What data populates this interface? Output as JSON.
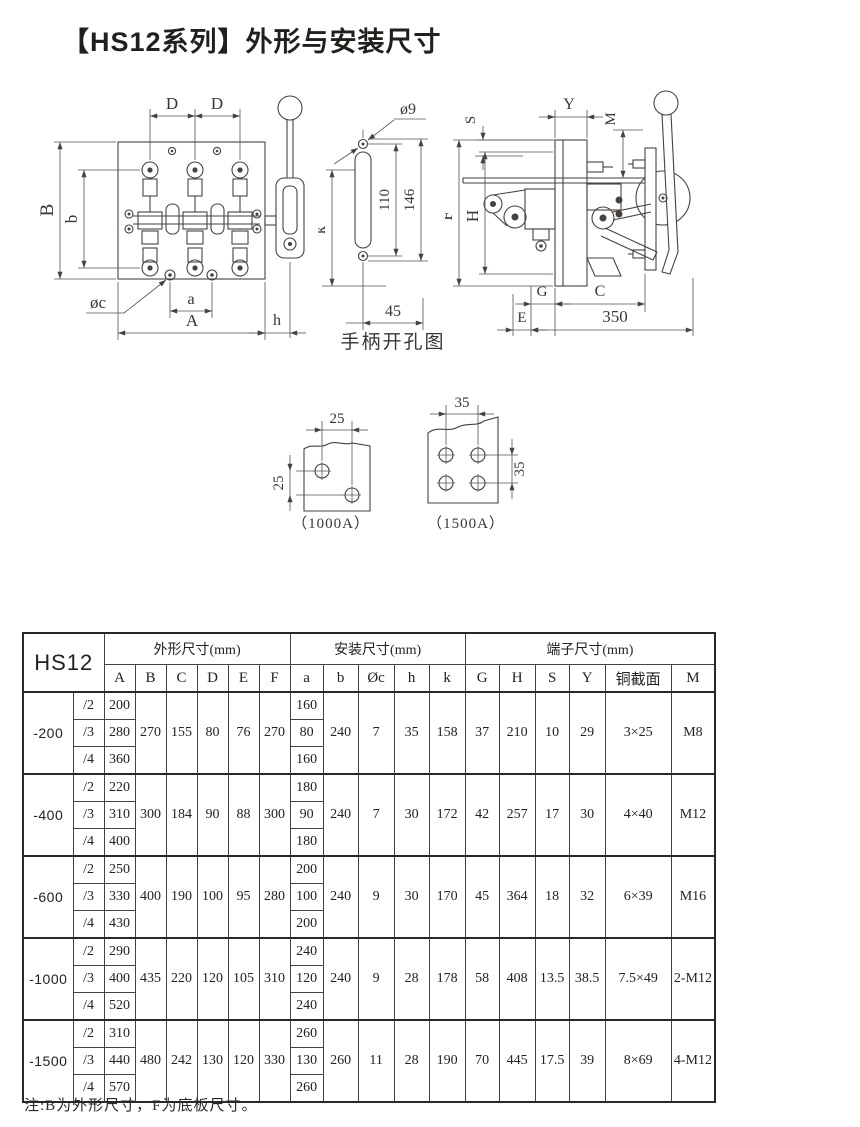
{
  "page": {
    "title": "【HS12系列】外形与安装尺寸",
    "note": "注:B为外形尺寸，F为底板尺寸。"
  },
  "figures": {
    "front_view": {
      "dims": {
        "D1": "D",
        "D2": "D",
        "B": "B",
        "b": "b",
        "phiC": "øc",
        "a": "a",
        "A": "A",
        "h": "h"
      }
    },
    "handle_cutout": {
      "caption": "手柄开孔图",
      "dims": {
        "phi9": "ø9",
        "v110": "110",
        "v146": "146",
        "k": "k",
        "h45": "45"
      }
    },
    "side_view": {
      "dims": {
        "S": "S",
        "Y": "Y",
        "M": "M",
        "F": "F",
        "H": "H",
        "G": "G",
        "C": "C",
        "E": "E",
        "w350": "350"
      }
    },
    "hole_1000A": {
      "caption": "（1000A）",
      "dims": {
        "h25": "25",
        "v25": "25"
      }
    },
    "hole_1500A": {
      "caption": "（1500A）",
      "dims": {
        "h35": "35",
        "v35": "35"
      }
    }
  },
  "table": {
    "model_header": "HS12",
    "groups": [
      {
        "label": "外形尺寸(mm)",
        "cols": [
          "A",
          "B",
          "C",
          "D",
          "E",
          "F"
        ]
      },
      {
        "label": "安装尺寸(mm)",
        "cols": [
          "a",
          "b",
          "Øc",
          "h",
          "k"
        ]
      },
      {
        "label": "端子尺寸(mm)",
        "cols": [
          "G",
          "H",
          "S",
          "Y",
          "铜截面",
          "M"
        ]
      }
    ],
    "rows": [
      {
        "model": "-200",
        "variants": [
          [
            "/2",
            "200",
            "160"
          ],
          [
            "/3",
            "280",
            "80"
          ],
          [
            "/4",
            "360",
            "160"
          ]
        ],
        "merged": [
          "270",
          "155",
          "80",
          "76",
          "270",
          "240",
          "7",
          "35",
          "158",
          "37",
          "210",
          "10",
          "29",
          "3×25",
          "M8"
        ]
      },
      {
        "model": "-400",
        "variants": [
          [
            "/2",
            "220",
            "180"
          ],
          [
            "/3",
            "310",
            "90"
          ],
          [
            "/4",
            "400",
            "180"
          ]
        ],
        "merged": [
          "300",
          "184",
          "90",
          "88",
          "300",
          "240",
          "7",
          "30",
          "172",
          "42",
          "257",
          "17",
          "30",
          "4×40",
          "M12"
        ]
      },
      {
        "model": "-600",
        "variants": [
          [
            "/2",
            "250",
            "200"
          ],
          [
            "/3",
            "330",
            "100"
          ],
          [
            "/4",
            "430",
            "200"
          ]
        ],
        "merged": [
          "400",
          "190",
          "100",
          "95",
          "280",
          "240",
          "9",
          "30",
          "170",
          "45",
          "364",
          "18",
          "32",
          "6×39",
          "M16"
        ]
      },
      {
        "model": "-1000",
        "variants": [
          [
            "/2",
            "290",
            "240"
          ],
          [
            "/3",
            "400",
            "120"
          ],
          [
            "/4",
            "520",
            "240"
          ]
        ],
        "merged": [
          "435",
          "220",
          "120",
          "105",
          "310",
          "240",
          "9",
          "28",
          "178",
          "58",
          "408",
          "13.5",
          "38.5",
          "7.5×49",
          "2-M12"
        ]
      },
      {
        "model": "-1500",
        "variants": [
          [
            "/2",
            "310",
            "260"
          ],
          [
            "/3",
            "440",
            "130"
          ],
          [
            "/4",
            "570",
            "260"
          ]
        ],
        "merged": [
          "480",
          "242",
          "130",
          "120",
          "330",
          "260",
          "11",
          "28",
          "190",
          "70",
          "445",
          "17.5",
          "39",
          "8×69",
          "4-M12"
        ]
      }
    ]
  }
}
